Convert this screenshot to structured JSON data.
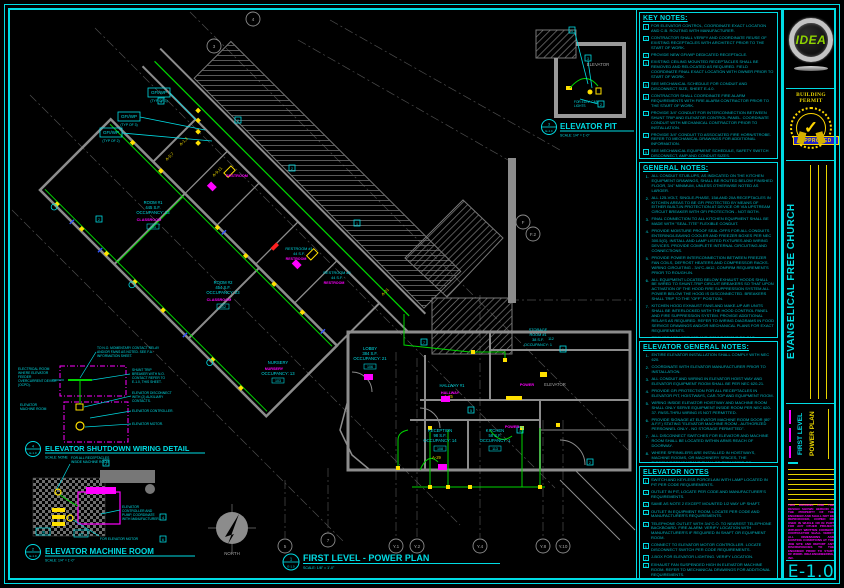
{
  "sheet": {
    "number": "E-1.0"
  },
  "titleblock": {
    "logo": "IDEA",
    "permit": "BUILDING PERMIT",
    "approved": "APPROVED",
    "approved_check": "✓",
    "project": "EVANGELICAL FREE CHURCH",
    "level": "FIRST LEVEL",
    "plan": "POWER PLAN",
    "sheet_no": "E-1.0",
    "disclaimer": "THIS DRAWING AND THE DESIGN SHOWN HEREON IS THE PROPERTY OF THE ENGINEER AND SHALL NOT BE REPRODUCED, COPIED OR USED IN WHOLE OR IN PART FOR ANY OTHER PROJECT WITHOUT WRITTEN CONSENT. CONTRACTOR SHALL VERIFY ALL DIMENSIONS AND EXISTING CONDITIONS AT THE JOB SITE AND REPORT ANY DISCREPANCIES TO THE ENGINEER PRIOR TO START OF WORK. IDEA ENGINEERING, INC."
  },
  "notes": {
    "key": {
      "title": "KEY NOTES:",
      "items": [
        {
          "n": "1",
          "t": "FOR ELEVATOR CONTROL, COORDINATE EXACT LOCATION AND C.B. ROUTING WITH MANUFACTURER."
        },
        {
          "n": "2",
          "t": "CONTRACTOR SHALL VERIFY AND COORDINATE REUSE OF EXISTING RECEPTACLES WITH ARCHITECT PRIOR TO THE START OF WORK."
        },
        {
          "n": "3",
          "t": "PROVIDE NEW GFI/WP DEDICATED RECEPTACLE."
        },
        {
          "n": "4",
          "t": "EXISTING CEILING MOUNTED RECEPTACLES SHALL BE REMOVED AND RELOCATED AS REQUIRED. FIELD COORDINATE FINAL EXACT LOCATION WITH OWNER PRIOR TO START OF WORK."
        },
        {
          "n": "5",
          "t": "SEE MECHANICAL SCHEDULE FOR CONDUIT AND DISCONNECT SIZE, SHEET E-4.0."
        },
        {
          "n": "6",
          "t": "CONTRACTOR SHALL COORDINATE FIRE ALARM REQUIREMENTS WITH FIRE ALARM CONTRACTOR PRIOR TO THE START OF WORK."
        },
        {
          "n": "7",
          "t": "PROVIDE 3/4\" CONDUIT FOR INTERCONNECTION BETWEEN SHUNT TRIP AND ELEVATOR CONTROL PANEL. COORDINATE CONDUIT WITH MECHANICAL CONTRACTOR PRIOR TO INSTALLATION."
        },
        {
          "n": "8",
          "t": "PROVIDE 3/4\" CONDUIT TO ASSOCIATED FIRE HORN/STROBE. REFER TO MECHANICAL DRAWINGS FOR ADDITIONAL INFORMATION."
        },
        {
          "n": "9",
          "t": "SEE MECHANICAL EQUIPMENT SCHEDULE, SAFETY SWITCH DISCONNECT, AMP AND CONDUIT SIZES."
        }
      ]
    },
    "general": {
      "title": "GENERAL NOTES:",
      "items": [
        {
          "n": "1",
          "t": "ALL CONDUIT STUB-UPS, AS INDICATED ON THE KITCHEN EQUIPMENT DRAWINGS, SHALL BE ROUTED BELOW FINISHED FLOOR, 3/4\" MINIMUM, UNLESS OTHERWISE NOTED AS LARGER."
        },
        {
          "n": "2",
          "t": "ALL 125-VOLT, SINGLE-PHASE, 15A AND 20A RECEPTACLES IN KITCHEN AREAS TO BE GFI PROTECTED BY MEANS OF EITHER BUILT-IN PROTECTION AT DEVICE OR VIA UPSTREAM CIRCUIT BREAKER WITH GFI PROTECTION - NOT BOTH."
        },
        {
          "n": "3",
          "t": "FINAL CONNECTION TO ALL KITCHEN EQUIPMENT SHALL BE MADE WITH \"SEAL-TITE\" FLEXIBLE CONDUIT."
        },
        {
          "n": "4",
          "t": "PROVIDE MOISTURE PROOF SEAL OFFS FOR ALL CONDUITS ENTERING/LEAVING COOLER AND FREEZER BOXES PER NEC 300.5(G). INSTALL AND LAMP LISTED FIXTURES AND WIRING DEVICES. PROVIDE COMPLETE INTERNAL CIRCUITING AND CONNECTIONS."
        },
        {
          "n": "5",
          "t": "PROVIDE POWER INTERCONNECTION BETWEEN FREEZER FAN COILS, DEFROST HEATERS AND COMPRESSOR RACKS. WIRING CIRCUITING - 3/4\"C-4#12, CONFIRM REQUIREMENTS PRIOR TO ROUGH-IN."
        },
        {
          "n": "6",
          "t": "ALL EQUIPMENT LOCATED BELOW EXHAUST HOODS SHALL BE WIRED TO SHUNT-TRIP CIRCUIT BREAKERS SO THAT UPON ACTIVATION OF THE HOOD FIRE SUPPRESSION SYSTEM ALL POWER BELOW THE HOOD IS DISCONNECTED. BREAKERS SHALL TRIP TO THE \"OFF\" POSITION."
        },
        {
          "n": "7",
          "t": "KITCHEN HOOD EXHAUST FANS AND MAKE-UP AIR UNITS SHALL BE INTERLOCKED WITH THE HOOD CONTROL PANEL AND FIRE SUPPRESSION SYSTEM. PROVIDE ADDITIONAL RELAYS AS REQUIRED. REFER TO WIRING DIAGRAMS IN FOOD SERVICE DRAWINGS AND/OR MECHANICAL PLANS FOR EXACT REQUIREMENTS."
        },
        {
          "n": "8",
          "t": "PROVIDE 120V SERVICE AND CONNECTIONS TO GAS SOLENOID VALVES, INTERCONNECT WITH HOOD CONTROL AND FIRE SUPPRESSION SYSTEM."
        },
        {
          "n": "9",
          "t": "PROVIDE 120V SERVICE AND CONNECTIONS TO FIRE ALARM SYSTEM PULL STATION AND INTERLOCK WITH SUPPRESSION \"ANSUL\" CONTROL PANEL - COORDINATE WITH SYSTEM INSTALLER PRIOR TO ROUGH-IN."
        },
        {
          "n": "10",
          "t": "ALL EXPOSED LAMPS IN DINING AND FOOD PREPARATION AREAS SHALL BE OF AN APPROVED \"UL\" COATED SHATTERPROOF LAMP."
        }
      ]
    },
    "elev_general": {
      "title": "ELEVATOR GENERAL NOTES:",
      "items": [
        {
          "n": "1",
          "t": "ENTIRE ELEVATOR INSTALLATION SHALL COMPLY WITH NEC 620."
        },
        {
          "n": "2",
          "t": "COORDINATE WITH ELEVATOR MANUFACTURER PRIOR TO INSTALLATION."
        },
        {
          "n": "3",
          "t": "ALL CONDUIT AND WIRING IN ELEVATOR HOIST WAY AND ELEVATOR EQUIPMENT ROOM SHALL BE PER NEC 620-21."
        },
        {
          "n": "4",
          "t": "PROVIDE GFI PROTECTION FOR ALL RECEPTACLES IN ELEVATOR PIT, HOISTWAYS, CAR-TOP AND EQUIPMENT ROOM."
        },
        {
          "n": "5",
          "t": "WIRING INSIDE ELEVATOR HOISTWAY AND MACHINE ROOM SHALL ONLY SERVE EQUIPMENT INSIDE ROOM PER NEC 620-37. PASS-THRU WIRING IS NOT PERMITTED."
        },
        {
          "n": "6",
          "t": "PROVIDE SIGNAGE AT ELEVATOR MACHINE ROOM DOOR (80\" A.F.F.) STATING \"ELEVATOR MACHINE ROOM - AUTHORIZED PERSONNEL ONLY - NO STORAGE PERMITTED\"."
        },
        {
          "n": "7",
          "t": "ALL DISCONNECT SWITCHES FOR ELEVATOR AND MACHINE ROOM SHALL BE LOCATED WITHIN ARMS REACH OF DOORWAY."
        },
        {
          "n": "8",
          "t": "WHERE SPRINKLERS ARE INSTALLED IN HOISTWAYS, MACHINE ROOMS, OR MACHINERY SPACES, THE DISCONNECTING MEANS SHALL BE PERMITTED TO AUTOMATICALLY OPEN THE POWER SUPPLY TO THE AFFECTED ELEVATOR(S) PRIOR TO THE APPLICATION OF WATER. NO PROVISIONS SHALL BE MADE TO AUTOMATICALLY CLOSE THIS DISCONNECTING MEANS. POWER SHALL ONLY BE RESTORED BY MANUAL MEANS. COORDINATE WITH FIRE ALARM PLANS (DEFERRED APPROVAL)"
        }
      ]
    },
    "elev": {
      "title": "ELEVATOR NOTES",
      "items": [
        {
          "n": "1",
          "t": "SWITCH AND KEYLESS PORCELAIN WITH LAMP LOCATED IN PIT PER CODE REQUIREMENTS."
        },
        {
          "n": "2",
          "t": "OUTLET IN PIT, LOCATE PER CODE AND MANUFACTURER'S REQUIREMENTS."
        },
        {
          "n": "3",
          "t": "SAME AS NOTE 2 EXCEPT MOUNTED 1/2 WAY UP SHAFT."
        },
        {
          "n": "4",
          "t": "OUTLET IN EQUIPMENT ROOM, LOCATE PER CODE AND MANUFACTURER'S REQUIREMENTS."
        },
        {
          "n": "5",
          "t": "TELEPHONE OUTLET WITH 3/4\"C.O. TO NEAREST TELEPHONE BACKBOARD. FIRE ALARM: VERIFY LOCATION WITH MANUFACTURER'S IF REQUIRED IN SHAFT OR EQUIPMENT ROOM."
        },
        {
          "n": "6",
          "t": "CONNECT TO ELEVATOR MOTOR CONTROLLER. LOCATE DISCONNECT SWITCH PER CODE REQUIREMENTS."
        },
        {
          "n": "7",
          "t": "J-BOX FOR ELEVATOR LIGHTING. VERIFY LOCATION."
        },
        {
          "n": "8",
          "t": "EXHAUST FAN SUSPENDED HIGH IN ELEVATOR MACHINE ROOM. REFER TO MECHANICAL DRAWINGS FOR ADDITIONAL REQUIREMENTS."
        },
        {
          "n": "9",
          "t": "DISCONNECT SWITCH WITH DUAL ELEMENT FUSES PER MANUFACTURER'S REQUIREMENTS. REFER TO SINGLE LINE FOR ADDITIONAL INFORMATION."
        }
      ]
    }
  },
  "plan": {
    "badge_n": "1",
    "badge_s": "E-1.0",
    "title": "FIRST LEVEL - POWER PLAN",
    "scale": "SCALE: 1/8\" = 1'-0\"",
    "north": "NORTH",
    "rooms": [
      {
        "name": "ROOM #1",
        "sf": "445 S.F.",
        "occ": "OCCUPANCY: 23",
        "tag": "CLASSROOM",
        "num": "101"
      },
      {
        "name": "ROOM #2",
        "sf": "454 S.F.",
        "occ": "OCCUPANCY: 23",
        "tag": "CLASSROOM",
        "num": "102"
      },
      {
        "name": "NURSERY",
        "sf": "",
        "occ": "OCCUPANCY: 13",
        "tag": "NURSERY",
        "num": "103"
      },
      {
        "name": "RESTROOM #1",
        "sf": "44 S.F.",
        "occ": "",
        "tag": "RESTROOM",
        "num": "104"
      },
      {
        "name": "RESTROOM #2",
        "sf": "44 S.F.",
        "occ": "",
        "tag": "RESTROOM",
        "num": "105"
      },
      {
        "name": "LOBBY",
        "sf": "384 S.F.",
        "occ": "OCCUPANCY: 21",
        "tag": "",
        "num": "106"
      },
      {
        "name": "HALLWAY #1",
        "sf": "",
        "occ": "",
        "tag": "HALLWAY",
        "num": "107"
      },
      {
        "name": "STORAGE",
        "name2": "ROOM #1",
        "sf": "38 S.F.",
        "occ": "OCCUPANCY: 1",
        "num": "112"
      },
      {
        "name": "RECEPTION",
        "sf": "98 S.F.",
        "occ": "OCCUPANCY: 14",
        "tag": "",
        "num": "108"
      },
      {
        "name": "KITCHEN",
        "sf": "58 S.F.",
        "occ": "OCCUPANCY: 1",
        "tag": "POWER",
        "num": "113"
      },
      {
        "name": "ELEVATOR",
        "tag": "POWER"
      },
      {
        "tag": "RESTROOM"
      }
    ],
    "callouts": [
      {
        "a": "GFI/WP",
        "b": "(TYP OF 3)"
      },
      {
        "a": "GFI/WP",
        "b": "(TYP OF 3)"
      },
      {
        "a": "GFI/WP",
        "b": "(TYP OF 2)"
      }
    ],
    "circuits": [
      "A-1,3",
      "A-5,7",
      "A-9,11",
      "A-25",
      "A-29",
      "A-31"
    ],
    "krefs": [
      "9",
      "2",
      "2",
      "1",
      "7",
      "5",
      "1",
      "2",
      "2",
      "1"
    ],
    "grid": [
      "3",
      "4",
      "F",
      "F.2",
      "5",
      "7",
      "Y.1",
      "Y.2",
      "Y.4",
      "Y.8",
      "Y.10"
    ]
  },
  "details": {
    "pit": {
      "badge_n": "3",
      "badge_s": "E-1.0",
      "title": "ELEVATOR PIT",
      "scale": "SCALE: 1/4\" = 1'-0\"",
      "elevator": "ELEVATOR",
      "cab1": "FOR ELEV. CAB",
      "cab2": "LIGHTS",
      "k1": "1",
      "k2": "2",
      "k3": "3"
    },
    "machine": {
      "badge_n": "2",
      "badge_s": "E-1.0",
      "title": "ELEVATOR MACHINE ROOM",
      "scale": "SCALE: 1/4\" = 1'-0\"",
      "c1": [
        "FOR ALL RECEPTACLES",
        "INSIDE MACHINE ROOM"
      ],
      "c2": [
        "ELEVATOR",
        "CONTROLLER AND",
        "PUMP, COORDINATE",
        "WITH MANUFACTURER."
      ],
      "c3": "FOR ELEVATOR MOTOR",
      "b1": "JB",
      "b2": "DS",
      "k2": "2",
      "k4": "4",
      "k6": "6"
    },
    "shutdown": {
      "badge_n": "4",
      "badge_s": "E-1.0",
      "title": "ELEVATOR SHUTDOWN WIRING DETAIL",
      "scale": "SCALE: NONE",
      "t1": [
        "TO N.O. MOMENTARY CONTACT RELAY",
        "AND/OR FA/NS AS NOTED. SEE F.A.",
        "INFORMATION SHEET."
      ],
      "t2": [
        "ELECTRICAL ROOM",
        "WHERE ELEVATOR",
        "FEEDER",
        "OVERCURRENT DEVICE",
        "(OCPD)."
      ],
      "t3": [
        "SHUNT TRIP",
        "BREAKER WITH N.O.",
        "CONTACT REFER TO",
        "E-1.0, THIS SHEET."
      ],
      "t4": [
        "ELEVATOR",
        "MACHINE ROOM"
      ],
      "t5": [
        "ELEVATOR DISCONNECT",
        "WITH (2) AUXILIARY",
        "CONTACTS."
      ],
      "t6": "ELEVATOR CONTROLLER.",
      "t7": "ELEVATOR MOTOR."
    }
  }
}
